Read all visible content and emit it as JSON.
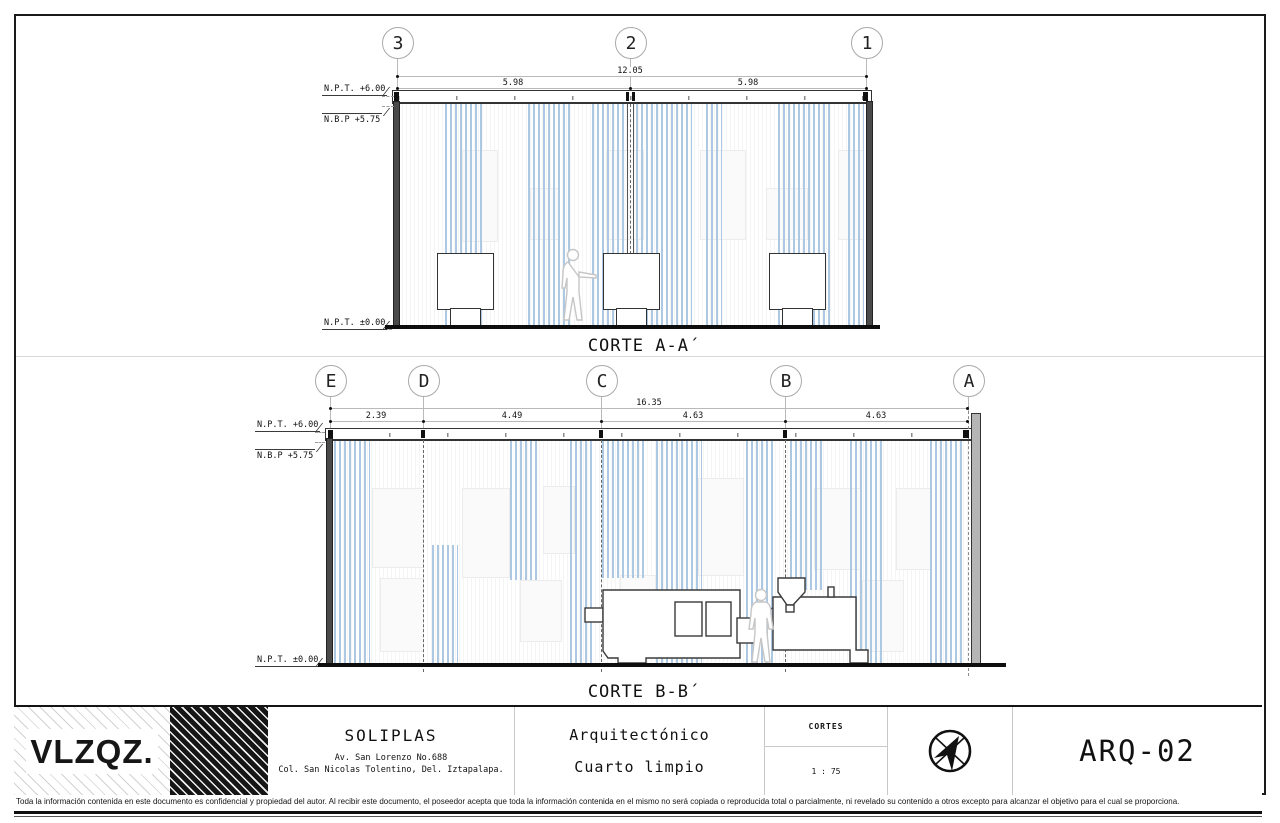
{
  "colors": {
    "curtain_blue": "#adc8e2"
  },
  "sections": {
    "a": {
      "title": "CORTE A-A´",
      "grid_bubbles": [
        "3",
        "2",
        "1"
      ],
      "dim_total": "12.05",
      "dim_segments": [
        "5.98",
        "5.98"
      ]
    },
    "b": {
      "title": "CORTE B-B´",
      "grid_bubbles": [
        "E",
        "D",
        "C",
        "B",
        "A"
      ],
      "dim_total": "16.35",
      "dim_segments": [
        "2.39",
        "4.49",
        "4.63",
        "4.63"
      ]
    }
  },
  "levels": {
    "npt_top": "N.P.T. +6.00",
    "nbp": "N.B.P +5.75",
    "npt_floor": "N.P.T. ±0.00"
  },
  "title_block": {
    "logo": "VLZQZ.",
    "client": "SOLIPLAS",
    "address_line1": "Av. San Lorenzo No.688",
    "address_line2": "Col. San Nicolas Tolentino, Del. Iztapalapa.",
    "project_type": "Arquitectónico",
    "project_name": "Cuarto limpio",
    "sheet_type_label": "CORTES",
    "scale": "1 : 75",
    "north_icon": "north-arrow-icon",
    "sheet_number": "ARQ-02"
  },
  "footer": {
    "disclaimer": "Toda la información contenida en este documento es confidencial y propiedad del autor. Al recibir este documento, el poseedor acepta que toda la información contenida en el mismo no será copiada o reproducida total o parcialmente, ni revelado su contenido a otros excepto para alcanzar el objetivo para el cual se proporciona."
  }
}
